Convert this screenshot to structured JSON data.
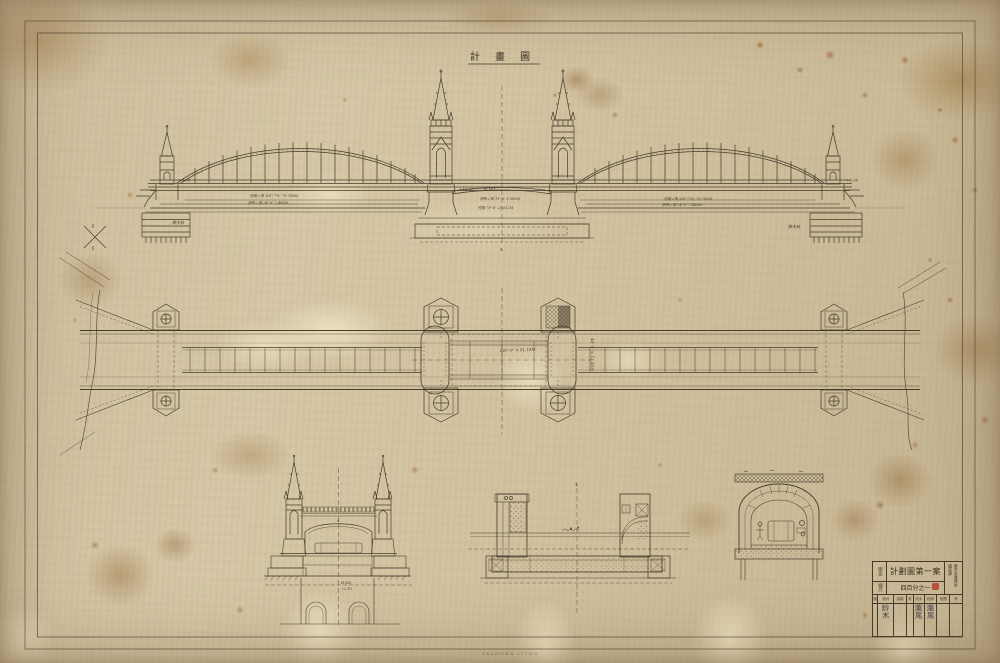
{
  "sheet": {
    "title": "計 畫 圖",
    "printer_credit": "OKAMURA LITHO"
  },
  "elevation": {
    "level_left": "+6.00",
    "level_right": "+6.00",
    "level_center": "+16.00",
    "hwl_label": "H.W.L",
    "span_note_left_1": "徑間ノ長 261'-7¾″ 79.765M",
    "span_note_left_2": "拱矢ノ高 24'-6″ 7.465M",
    "center_note_1": "拱矢ノ高 11'-6″ 3.505M",
    "center_note_2": "徑間 75'-6″ 23.012M",
    "span_note_right_1": "徑間ノ長 261'-7¾″ 79.765M",
    "span_note_right_2": "拱矢ノ高 24'-6″ 7.465M",
    "pile_label_left": "鉄大杭",
    "pile_label_right": "鉄大杭",
    "centerline_mark": "℄"
  },
  "plan": {
    "center_dimension": "240'-0″ ≒ 91.19M",
    "side_dimension": "44'-0″ ≒ 13.41M"
  },
  "details": {
    "portal_hwl": "H.W.L",
    "portal_level": "+2.10",
    "centerline_mark": "℄"
  },
  "titleblock": {
    "name_label": "圖名",
    "drawing_title": "計劃圖第一案",
    "scale_label": "縮尺",
    "scale_value": "四百分之一",
    "agency_line1": "東京市復興局",
    "agency_line2": "橋梁課",
    "headers": [
      "圖",
      "設計",
      "製圖",
      "寫",
      "技手",
      "技師",
      "檢閲",
      "考"
    ],
    "signatures": [
      "",
      "鈴木",
      "",
      "",
      "瀧尾",
      "瀧尾",
      "",
      ""
    ]
  }
}
